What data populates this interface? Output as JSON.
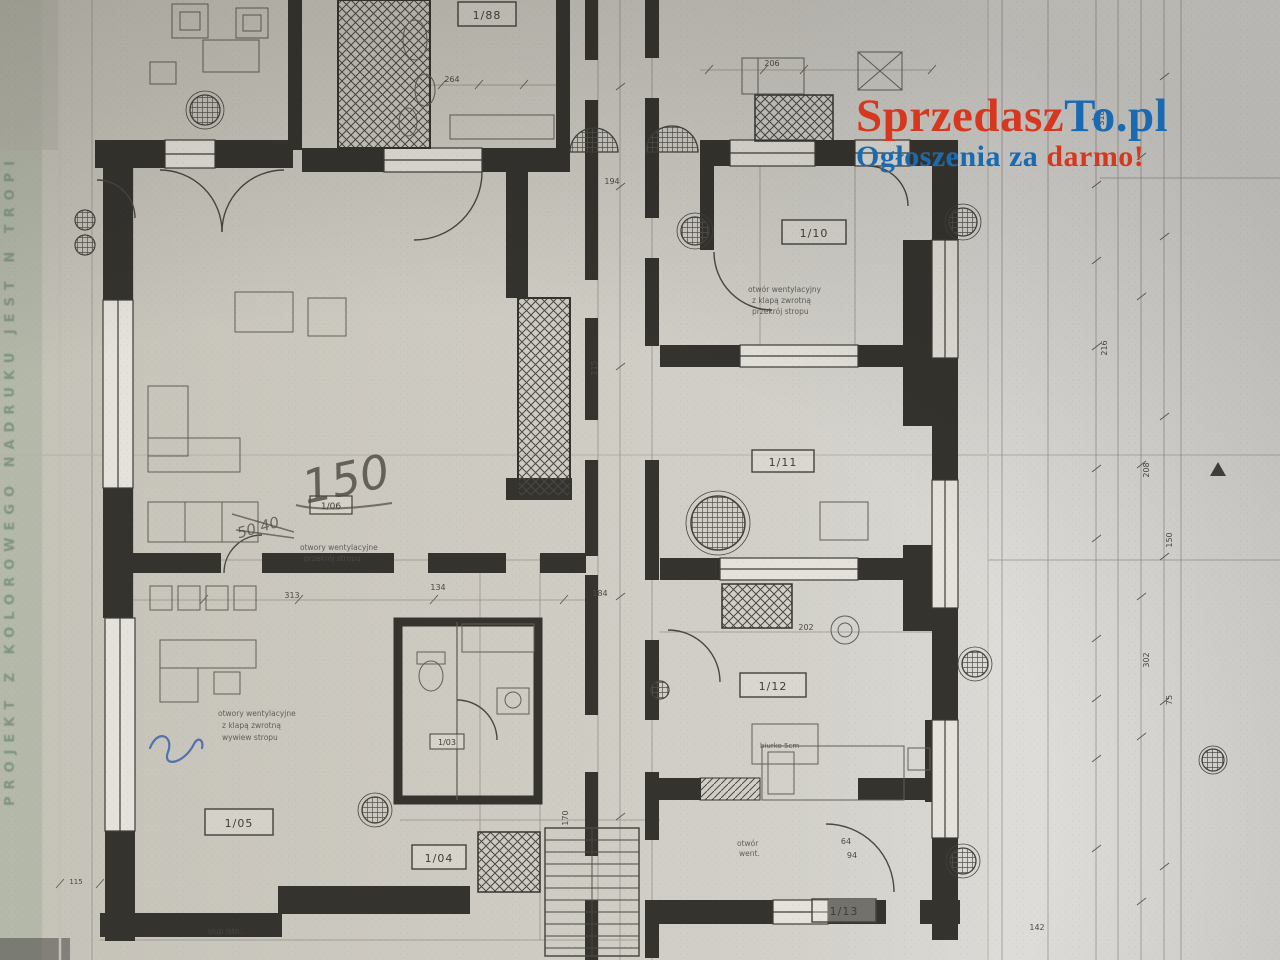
{
  "watermark": {
    "brand_red": "Sprzedasz",
    "brand_blue": "To.pl",
    "tagline_blue": "Ogłoszenia za",
    "tagline_red": "darmo!",
    "color_red": "#d6371f",
    "color_blue": "#1a6ab1"
  },
  "stamp": {
    "left_vertical_text": "PROJEKT Z KOLOROWEGO NADRUKU JEST N TROPI"
  },
  "plan": {
    "room_labels": [
      {
        "text": "1/88"
      },
      {
        "text": "1/10"
      },
      {
        "text": "1/11"
      },
      {
        "text": "1/12"
      },
      {
        "text": "1/13"
      },
      {
        "text": "1/05"
      },
      {
        "text": "1/04"
      },
      {
        "text": "1/06"
      },
      {
        "text": "1/03"
      }
    ],
    "handwritten": {
      "area_note": "150",
      "crossed_out": "50 40"
    },
    "annotations": {
      "blockA": [
        "otwory wentylacyjne",
        "przekrój stropu"
      ],
      "blockB": [
        "otwór wentylacyjny",
        "z klapą zwrotną",
        "przekrój stropu"
      ],
      "blockC": [
        "otwory wentylacyjne",
        "z klapą zwrotną",
        "wywiew stropu"
      ],
      "blockD": [
        "otwór",
        "went."
      ],
      "desk_note": "biurko 5cm",
      "column_note": "słup istn."
    },
    "dimensions": [
      {
        "v": "264"
      },
      {
        "v": "206"
      },
      {
        "v": "194"
      },
      {
        "v": "115"
      },
      {
        "v": "134"
      },
      {
        "v": "184"
      },
      {
        "v": "313"
      },
      {
        "v": "202"
      },
      {
        "v": "170"
      },
      {
        "v": "64"
      },
      {
        "v": "94"
      },
      {
        "v": "142"
      },
      {
        "v": "318"
      },
      {
        "v": "216"
      },
      {
        "v": "208"
      },
      {
        "v": "302"
      },
      {
        "v": "75"
      },
      {
        "v": "150"
      },
      {
        "v": "115"
      }
    ]
  }
}
